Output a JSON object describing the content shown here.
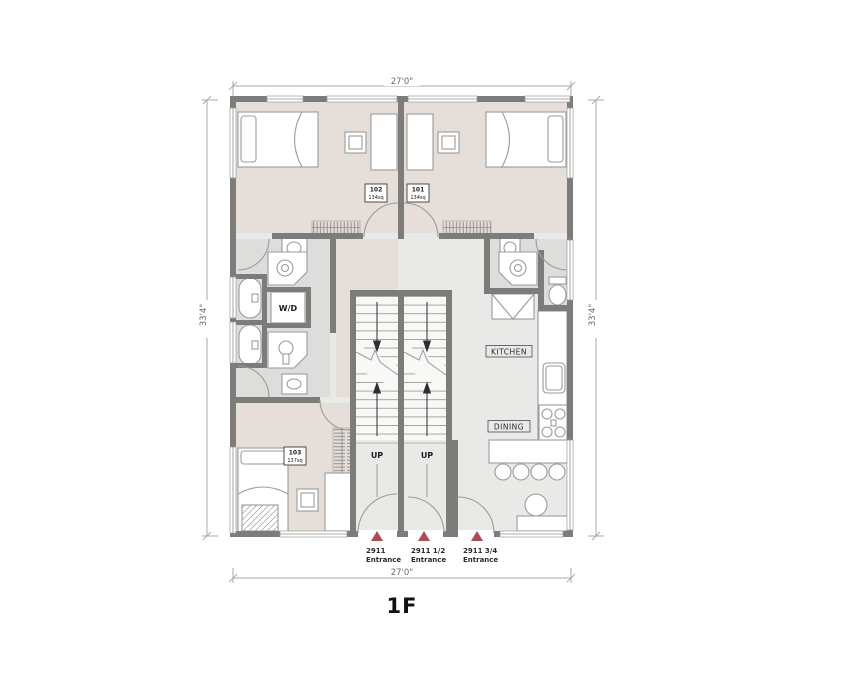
{
  "title": "1F",
  "dimensions": {
    "top": "27'0\"",
    "bottom": "27'0\"",
    "left": "33'4\"",
    "right": "33'4\""
  },
  "rooms": {
    "r102": {
      "number": "102",
      "area": "134sq"
    },
    "r101": {
      "number": "101",
      "area": "134sq"
    },
    "r103": {
      "number": "103",
      "area": "137sq"
    },
    "kitchen_label": "KITCHEN",
    "dining_label": "DINING",
    "laundry_label": "W/D"
  },
  "stairs": {
    "left_up": "UP",
    "right_up": "UP"
  },
  "entrances": [
    {
      "address": "2911",
      "label": "Entrance"
    },
    {
      "address": "2911 1/2",
      "label": "Entrance"
    },
    {
      "address": "2911 3/4",
      "label": "Entrance"
    }
  ],
  "colors": {
    "wall": "#7c7c7a",
    "bedroom_floor": "#e6ded8",
    "common_floor": "#e9e9e7",
    "bath_floor": "#dddddb",
    "stair_floor": "#f8f8f7",
    "entrance_marker": "#b04a52",
    "furniture_line": "#9b9b99",
    "dimension_line": "#aaaaa8"
  }
}
